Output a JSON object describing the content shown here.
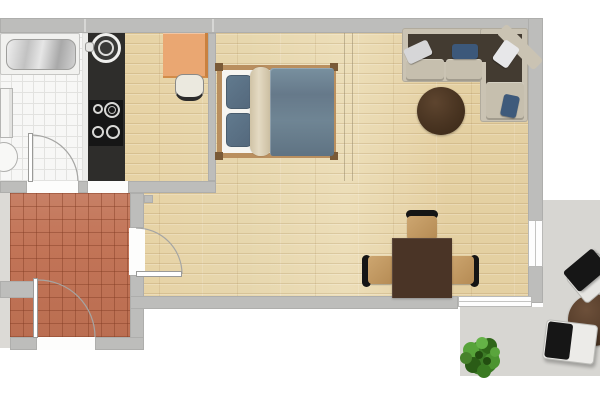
{
  "plan_title": "studio-apartment-floor-plan",
  "palette": {
    "wall": "#bdbdbb",
    "wood": "#e7d7ae",
    "tile_bath": "#f7f7f6",
    "tile_grout": "#e2e2e0",
    "terracotta": "#c27457",
    "balcony": "#d7d6d2",
    "counter": "#2e2d2b",
    "cooktop": "#161616",
    "sofa": "#cac3b3",
    "sofa_inner": "#433b31",
    "bed_frame": "#b98f5f",
    "bed_duvet": "#6d8191",
    "bed_pillow": "#5b7286",
    "bed_roll": "#d8ccb2",
    "desk": "#eaa772",
    "table_dark": "#4a3426",
    "chair_wood": "#c49a63",
    "cushion_black": "#161616",
    "plant_green": "#3c7a26",
    "door_arc": "#a5a5a3"
  },
  "rooms": [
    {
      "id": "bathroom",
      "floor": "white-tile"
    },
    {
      "id": "kitchen",
      "floor": "wood"
    },
    {
      "id": "living-bedroom",
      "floor": "wood"
    },
    {
      "id": "hallway",
      "floor": "terracotta-tile"
    },
    {
      "id": "balcony",
      "floor": "gray-stone"
    }
  ],
  "furniture": [
    {
      "id": "bathtub",
      "room": "bathroom"
    },
    {
      "id": "vanity-cabinet",
      "room": "bathroom"
    },
    {
      "id": "toilet",
      "room": "bathroom"
    },
    {
      "id": "kitchen-counter",
      "room": "kitchen"
    },
    {
      "id": "kitchen-sink",
      "room": "kitchen"
    },
    {
      "id": "cooktop",
      "room": "kitchen",
      "burners": 4
    },
    {
      "id": "desk",
      "room": "living-bedroom"
    },
    {
      "id": "desk-chair",
      "room": "living-bedroom"
    },
    {
      "id": "double-bed",
      "room": "living-bedroom",
      "pillows": 2
    },
    {
      "id": "corner-sofa",
      "room": "living-bedroom",
      "pillows": 4
    },
    {
      "id": "coffee-table",
      "room": "living-bedroom",
      "shape": "round"
    },
    {
      "id": "dining-table",
      "room": "living-bedroom",
      "shape": "square"
    },
    {
      "id": "dining-chair",
      "room": "living-bedroom",
      "count": 3
    },
    {
      "id": "balcony-table",
      "room": "balcony",
      "shape": "round"
    },
    {
      "id": "balcony-chair",
      "room": "balcony",
      "count": 2
    },
    {
      "id": "potted-plant",
      "room": "balcony"
    }
  ],
  "doors": [
    {
      "id": "bathroom-door",
      "type": "swing"
    },
    {
      "id": "hallway-entry-door",
      "type": "swing"
    },
    {
      "id": "hallway-living-door",
      "type": "swing"
    },
    {
      "id": "balcony-window-right",
      "type": "window"
    },
    {
      "id": "balcony-window-bottom",
      "type": "window"
    }
  ]
}
